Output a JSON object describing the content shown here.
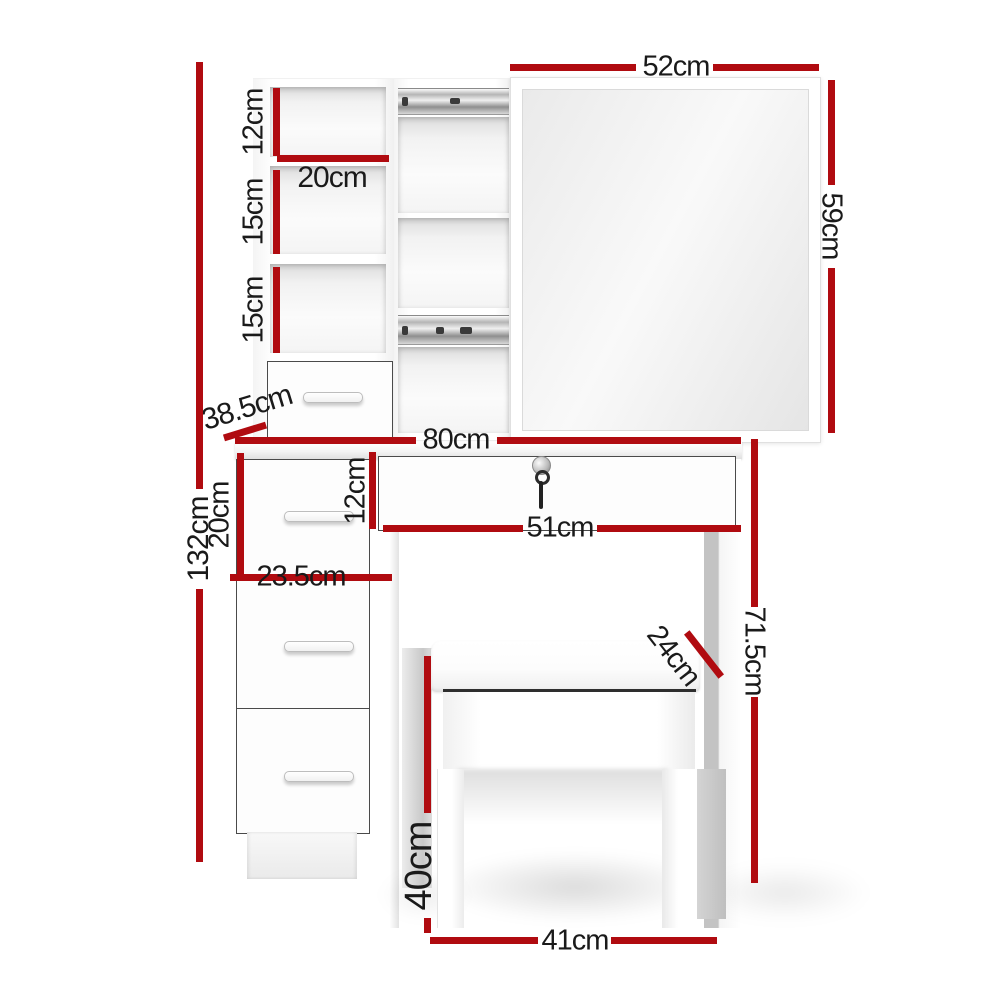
{
  "diagram": {
    "type": "product-dimension-diagram",
    "subject": "dressing table with sliding mirror, shelf tower, lockable drawer and stool",
    "unit": "cm",
    "accent_color": "#b00b10",
    "text_color": "#1a1a1a"
  },
  "dimensions": {
    "mirror_width": "52cm",
    "mirror_height": "59cm",
    "top_shelf_height": "12cm",
    "shelf_width": "20cm",
    "middle_shelf_height": "15cm",
    "lower_shelf_height": "15cm",
    "hutch_depth": "38.5cm",
    "desk_width": "80cm",
    "total_height": "132cm",
    "side_drawer_height": "20cm",
    "side_drawer_width": "23.5cm",
    "top_drawer_height": "12cm",
    "top_drawer_width": "51cm",
    "desk_height": "71.5cm",
    "stool_depth": "24cm",
    "stool_height": "40cm",
    "stool_width": "41cm"
  }
}
